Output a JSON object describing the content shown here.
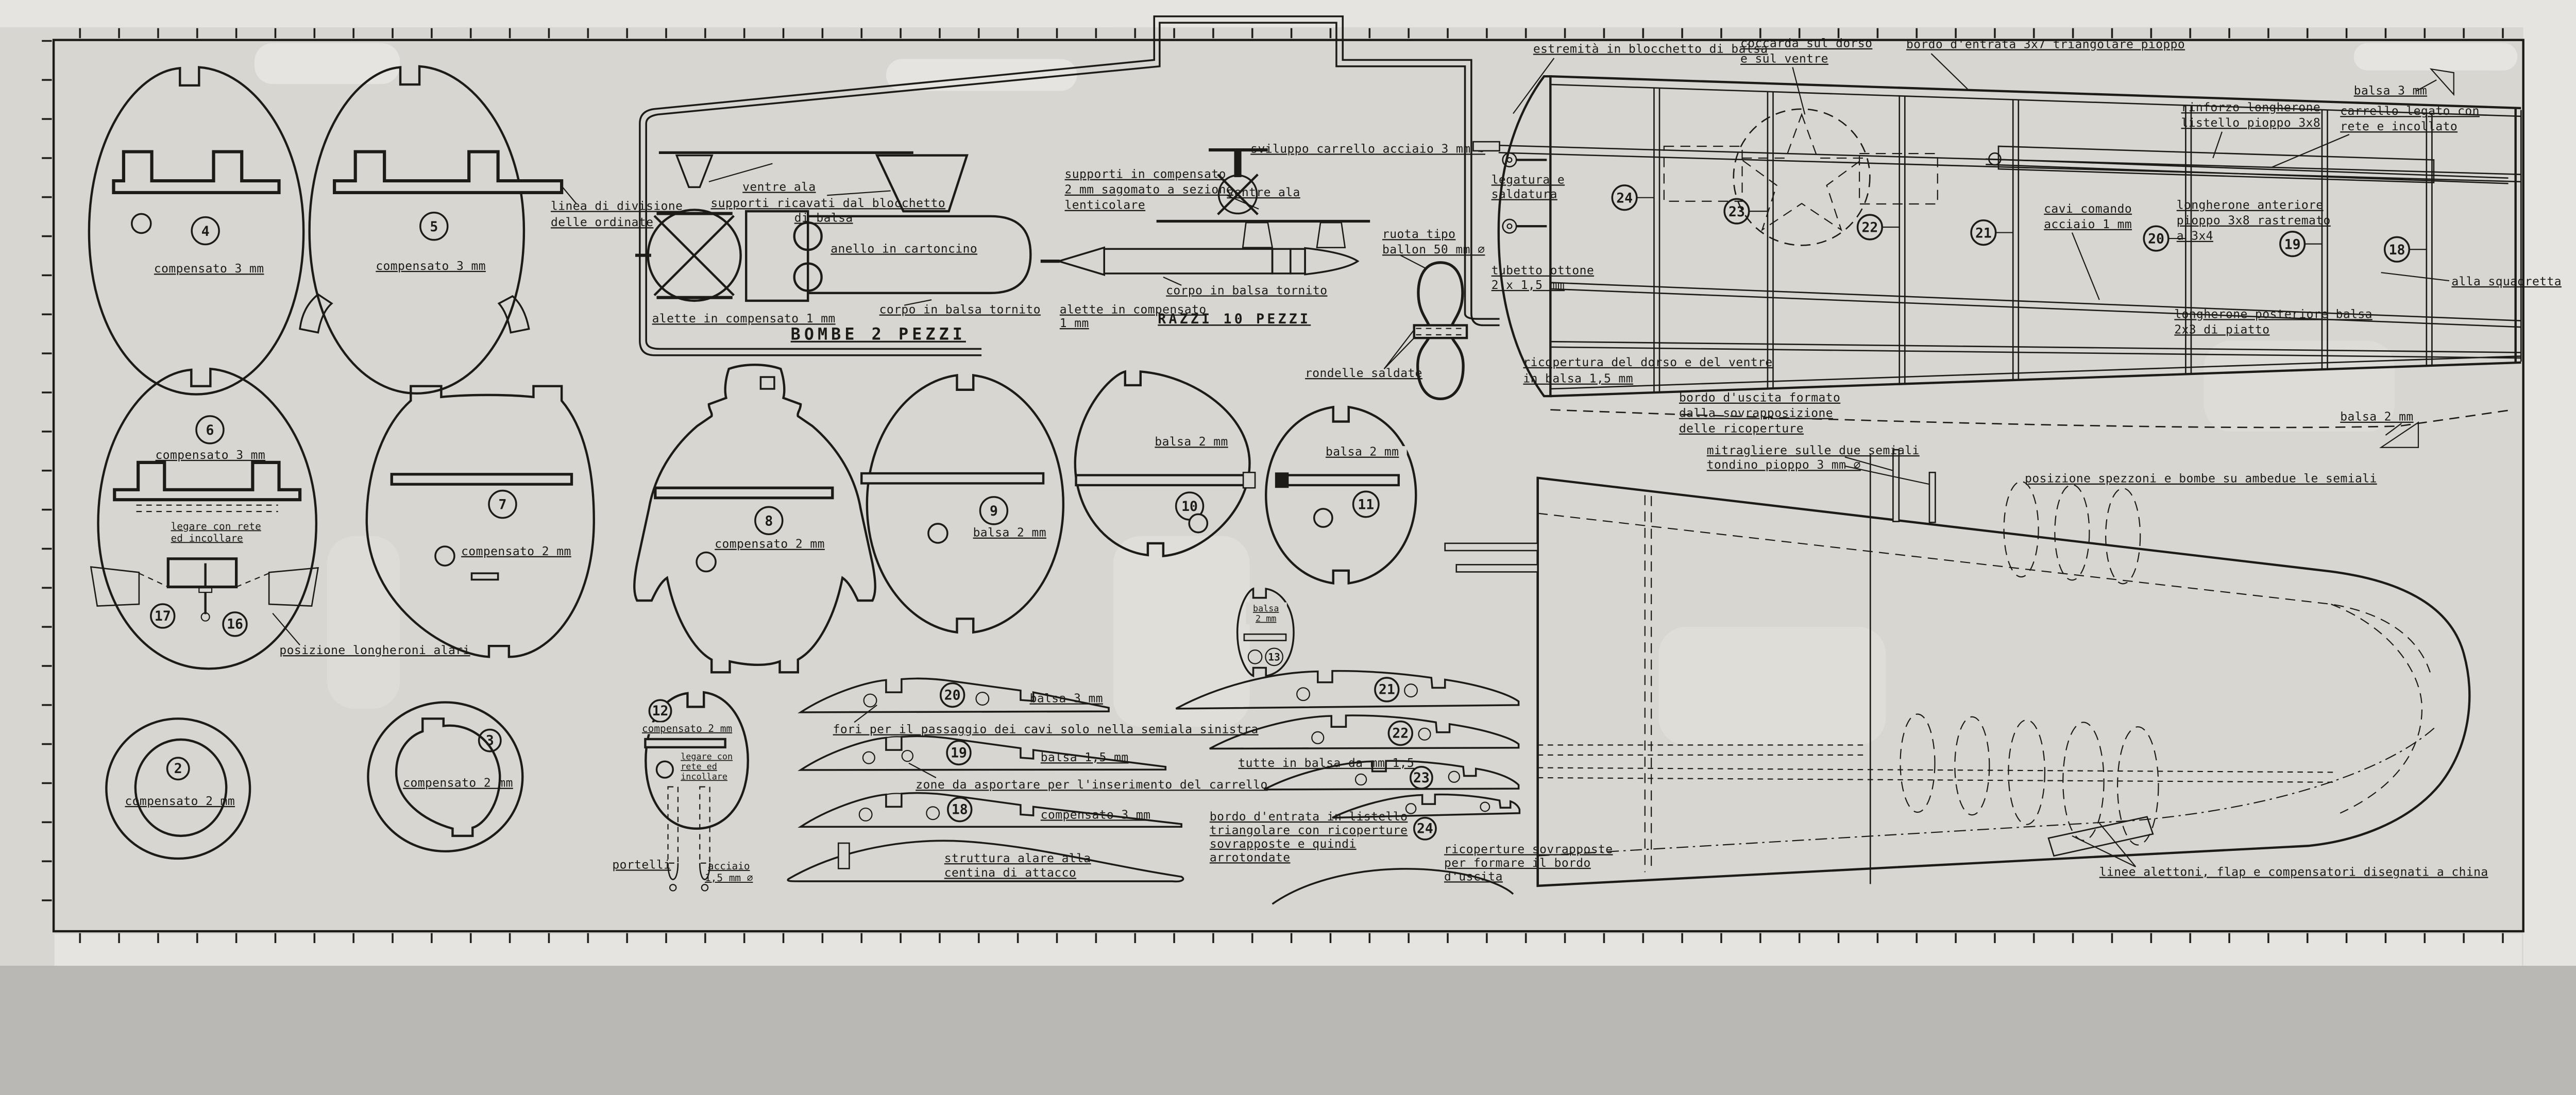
{
  "colors": {
    "paper": "#d8d6d0",
    "ink": "#1c1b17"
  },
  "f": {
    "f2": {
      "num": "2",
      "mat": "compensato 2 mm"
    },
    "f3": {
      "num": "3",
      "mat": "compensato 2 mm"
    },
    "f4": {
      "num": "4",
      "mat": "compensato 3 mm"
    },
    "f5": {
      "num": "5",
      "mat": "compensato 3 mm"
    },
    "f6": {
      "num": "6",
      "mat": "compensato 3 mm"
    },
    "f7": {
      "num": "7",
      "mat": "compensato 2 mm"
    },
    "f8": {
      "num": "8",
      "mat": "compensato 2 mm"
    },
    "f9": {
      "num": "9",
      "mat": "balsa 2 mm"
    },
    "f10": {
      "num": "10",
      "mat": "balsa 2 mm"
    },
    "f11": {
      "num": "11",
      "mat": "balsa 2 mm"
    },
    "f12": {
      "num": "12",
      "mat": "compensato 2 mm"
    },
    "f13": {
      "num": "13",
      "mat1": "balsa",
      "mat2": "2 mm"
    },
    "f16": {
      "num": "16"
    },
    "f17": {
      "num": "17"
    }
  },
  "r": {
    "r18": {
      "num": "18",
      "mat": "compensato 3 mm"
    },
    "r19": {
      "num": "19",
      "mat": "balsa 1,5 mm"
    },
    "r20": {
      "num": "20",
      "mat": "balsa 3 mm"
    },
    "r21": {
      "num": "21"
    },
    "r22": {
      "num": "22"
    },
    "r23": {
      "num": "23"
    },
    "r24": {
      "num": "24"
    }
  },
  "c": {
    "linea1": "linea di divisione",
    "linea2": "delle ordinate",
    "ventre": "ventre ala",
    "suppbloc1": "supporti ricavati dal blocchetto",
    "suppbloc2": "di balsa",
    "anello": "anello in cartoncino",
    "corpo": "corpo in balsa tornito",
    "alette": "alette in compensato 1 mm",
    "alette1": "alette in compensato",
    "alette2": "1 mm",
    "bombe": "BOMBE 2 PEZZI",
    "razzi": "RAZZI 10 PEZZI",
    "supplent1": "supporti in compensato",
    "supplent2": "2 mm sagomato a sezione",
    "supplent3": "lenticolare",
    "sviluppo": "sviluppo carrello acciaio 3 mm ∅",
    "ruota1": "ruota tipo",
    "ruota2": "ballon 50 mm ∅",
    "rondelle": "rondelle saldate",
    "legatura1": "legatura e",
    "legatura2": "saldatura",
    "tubetto1": "tubetto ottone",
    "tubetto2": "2 x 1,5 mm",
    "ricop1": "ricopertura del dorso e del ventre",
    "ricop2": "in balsa 1,5 mm",
    "uscita1": "bordo d'uscita formato",
    "uscita2": "dalla sovrapposizione",
    "uscita3": "delle ricoperture",
    "estrem": "estremità in blocchetto di balsa",
    "cocc1": "coccarda sul dorso",
    "cocc2": "e sul ventre",
    "entrata": "bordo d'entrata 3x7 triangolare pioppo",
    "balsa3": "balsa 3 mm",
    "rinf1": "rinforzo longherone",
    "rinf2": "listello pioppo 3x8",
    "carleg1": "carrello legato con",
    "carleg2": "rete e incollato",
    "cavi1": "cavi comando",
    "cavi2": "acciaio 1 mm",
    "langant1": "longherone anteriore",
    "langant2": "pioppo 3x8 rastremato",
    "langant3": "a 3x4",
    "langpost1": "longherone posteriore balsa",
    "langpost2": "2x3 di piatto",
    "squadretta": "alla squadretta",
    "balsa2": "balsa 2 mm",
    "legare1": "legare con rete",
    "legare2": "ed incollare",
    "leg121": "legare con",
    "leg122": "rete ed",
    "leg123": "incollare",
    "poslong": "posizione longheroni alari",
    "portelli": "portelli",
    "acc1": "acciaio",
    "acc2": "1,5 mm ∅",
    "fori": "fori per il passaggio dei cavi solo nella semiala sinistra",
    "zone": "zone da asportare per l'inserimento del carrello",
    "tutte": "tutte in balsa da mm 1,5",
    "list1": "bordo d'entrata in listello",
    "list2": "triangolare con ricoperture",
    "list3": "sovrapposte e quindi",
    "list4": "arrotondate",
    "ricsov1": "ricoperture sovrapposte",
    "ricsov2": "per formare il bordo",
    "ricsov3": "d'uscita",
    "strutt1": "struttura alare alla",
    "strutt2": "centina di attacco",
    "mitr1": "mitragliere sulle due semiali",
    "mitr2": "tondino pioppo 3 mm ∅",
    "spezzoni": "posizione spezzoni e bombe su ambedue le semiali",
    "linee": "linee alettoni, flap e compensatori disegnati a china"
  }
}
